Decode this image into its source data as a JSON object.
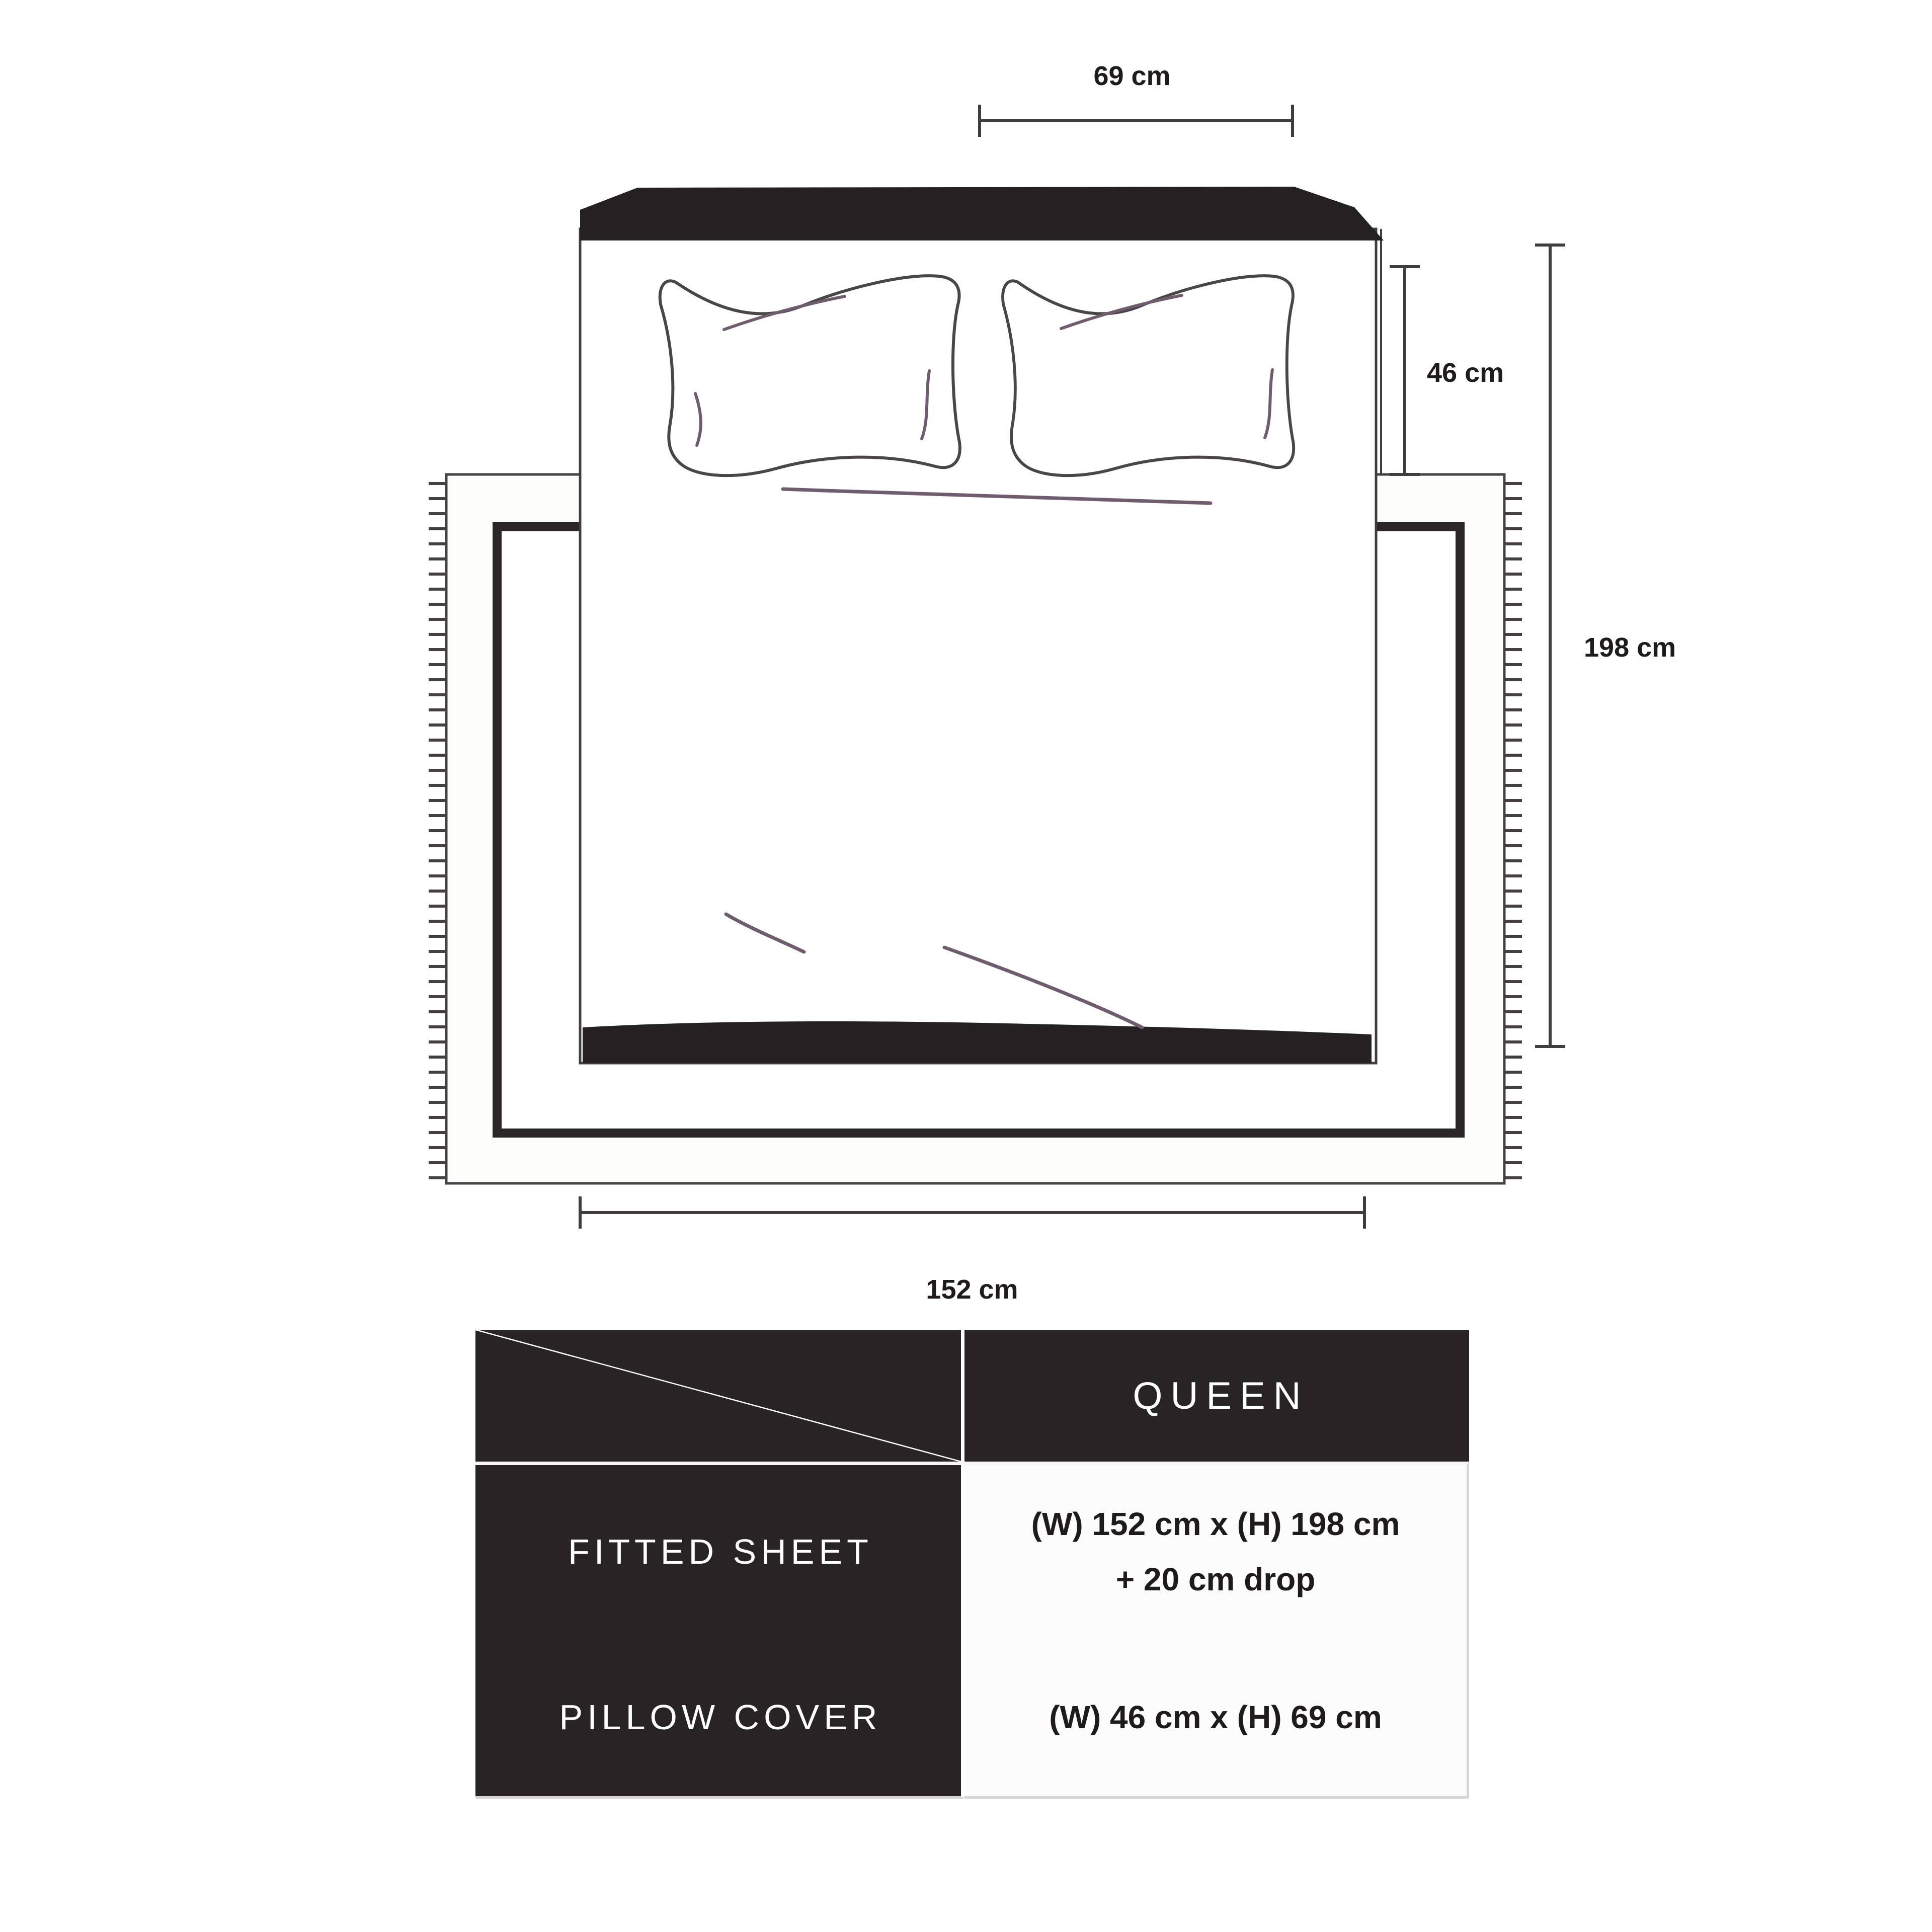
{
  "diagram": {
    "labels": {
      "pillow_width": "69 cm",
      "pillow_height": "46 cm",
      "bed_length": "198 cm",
      "bed_width": "152 cm"
    }
  },
  "size_table": {
    "column_header": "QUEEN",
    "rows": [
      {
        "label": "FITTED SHEET",
        "value_line1": "(W) 152 cm x (H) 198 cm",
        "value_line2": "+ 20 cm drop"
      },
      {
        "label": "PILLOW COVER",
        "value_line1": "(W) 46 cm x (H) 69 cm",
        "value_line2": ""
      }
    ]
  },
  "colors": {
    "ink_dark": "#252122",
    "outline_gray": "#45403f",
    "crease_purple": "#6f5c6f",
    "table_dark": "#282425",
    "divider_gray": "#cbc4c9",
    "value_bg": "#fdfcfd"
  }
}
